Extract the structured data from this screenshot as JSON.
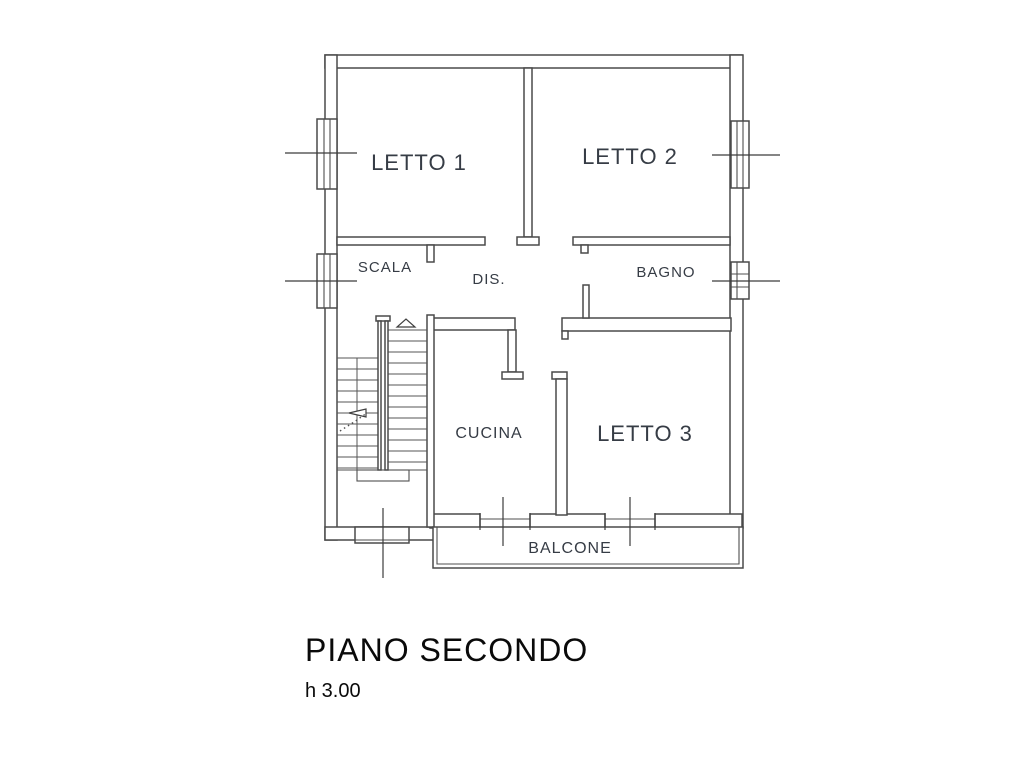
{
  "plan": {
    "type": "floor-plan",
    "title": "PIANO SECONDO",
    "height_label": "h 3.00",
    "rooms": [
      {
        "id": "letto1",
        "label": "LETTO 1"
      },
      {
        "id": "letto2",
        "label": "LETTO 2"
      },
      {
        "id": "scala",
        "label": "SCALA"
      },
      {
        "id": "dis",
        "label": "DIS."
      },
      {
        "id": "bagno",
        "label": "BAGNO"
      },
      {
        "id": "cucina",
        "label": "CUCINA"
      },
      {
        "id": "letto3",
        "label": "LETTO 3"
      },
      {
        "id": "balcone",
        "label": "BALCONE"
      }
    ],
    "features": {
      "windows": 4,
      "balcony_doors": 2,
      "staircase": "double flight with up arrow",
      "entry_step": "bottom left"
    },
    "colors": {
      "background": "#ffffff",
      "wall_line": "#4a4a4a",
      "room_label": "#363c45",
      "title": "#0a0a0a"
    }
  }
}
